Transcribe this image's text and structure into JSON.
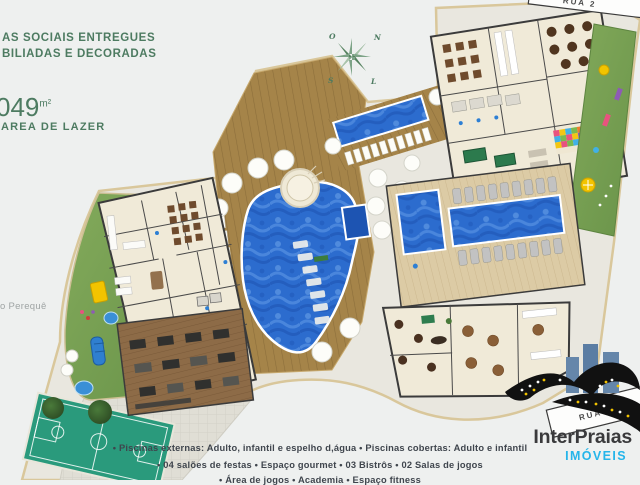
{
  "header": {
    "title_line1": "AS SOCIAIS ENTREGUES",
    "title_line2": "BILIADAS E DECORADAS",
    "area_number": "049",
    "area_unit": "m²",
    "area_label": "AREA DE LAZER"
  },
  "map": {
    "river_label": "o Perequê",
    "road_top_label": "RUA 2",
    "road_bottom_label": "RUA 272",
    "compass": {
      "west": "O",
      "north": "N",
      "south": "S",
      "east": "L"
    }
  },
  "captions": {
    "line1": "•   Piscinas externas:  Adulto, infantil e espelho d,água   •   Piscinas cobertas:  Adulto e infantil",
    "line2": "•   04 salões de festas   •   Espaço gourmet   •   03 Bistrôs   •   02 Salas de jogos",
    "line3_partial": "•   Área de jogos   •   Academia   •   Espaço fitness"
  },
  "logo": {
    "name": "InterPraias",
    "tagline": "IMÓVEIS"
  },
  "colors": {
    "accent_green": "#4d7b61",
    "pool_blue": "#2c6cce",
    "deck_wood": "#a58449",
    "logo_cyan": "#25b5ea",
    "caption_gray": "#3f454d"
  }
}
